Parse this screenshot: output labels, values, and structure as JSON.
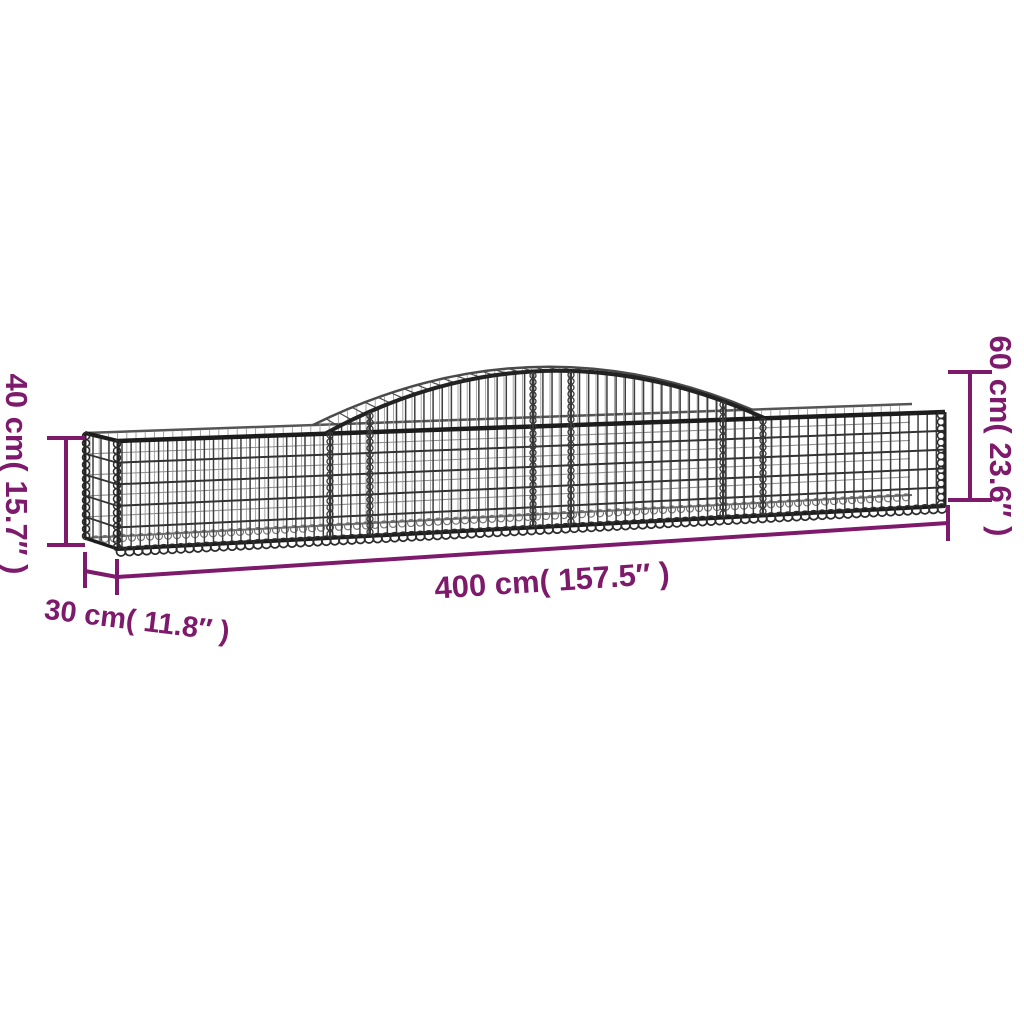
{
  "colors": {
    "background": "#ffffff",
    "accent": "#7d1a6b",
    "wire": "#3e3e3e",
    "rail": "#1c1c1c",
    "wire_back": "#9b9b9b"
  },
  "dimensions": {
    "length": {
      "label": "400 cm( 157.5″ )",
      "cm": 400,
      "inches": 157.5
    },
    "depth": {
      "label": "30 cm( 11.8″ )",
      "cm": 30,
      "inches": 11.8
    },
    "end_height": {
      "label": "40 cm( 15.7″ )",
      "cm": 40,
      "inches": 15.7
    },
    "middle_height": {
      "label": "60 cm( 23.6″ )",
      "cm": 60,
      "inches": 23.6
    }
  }
}
